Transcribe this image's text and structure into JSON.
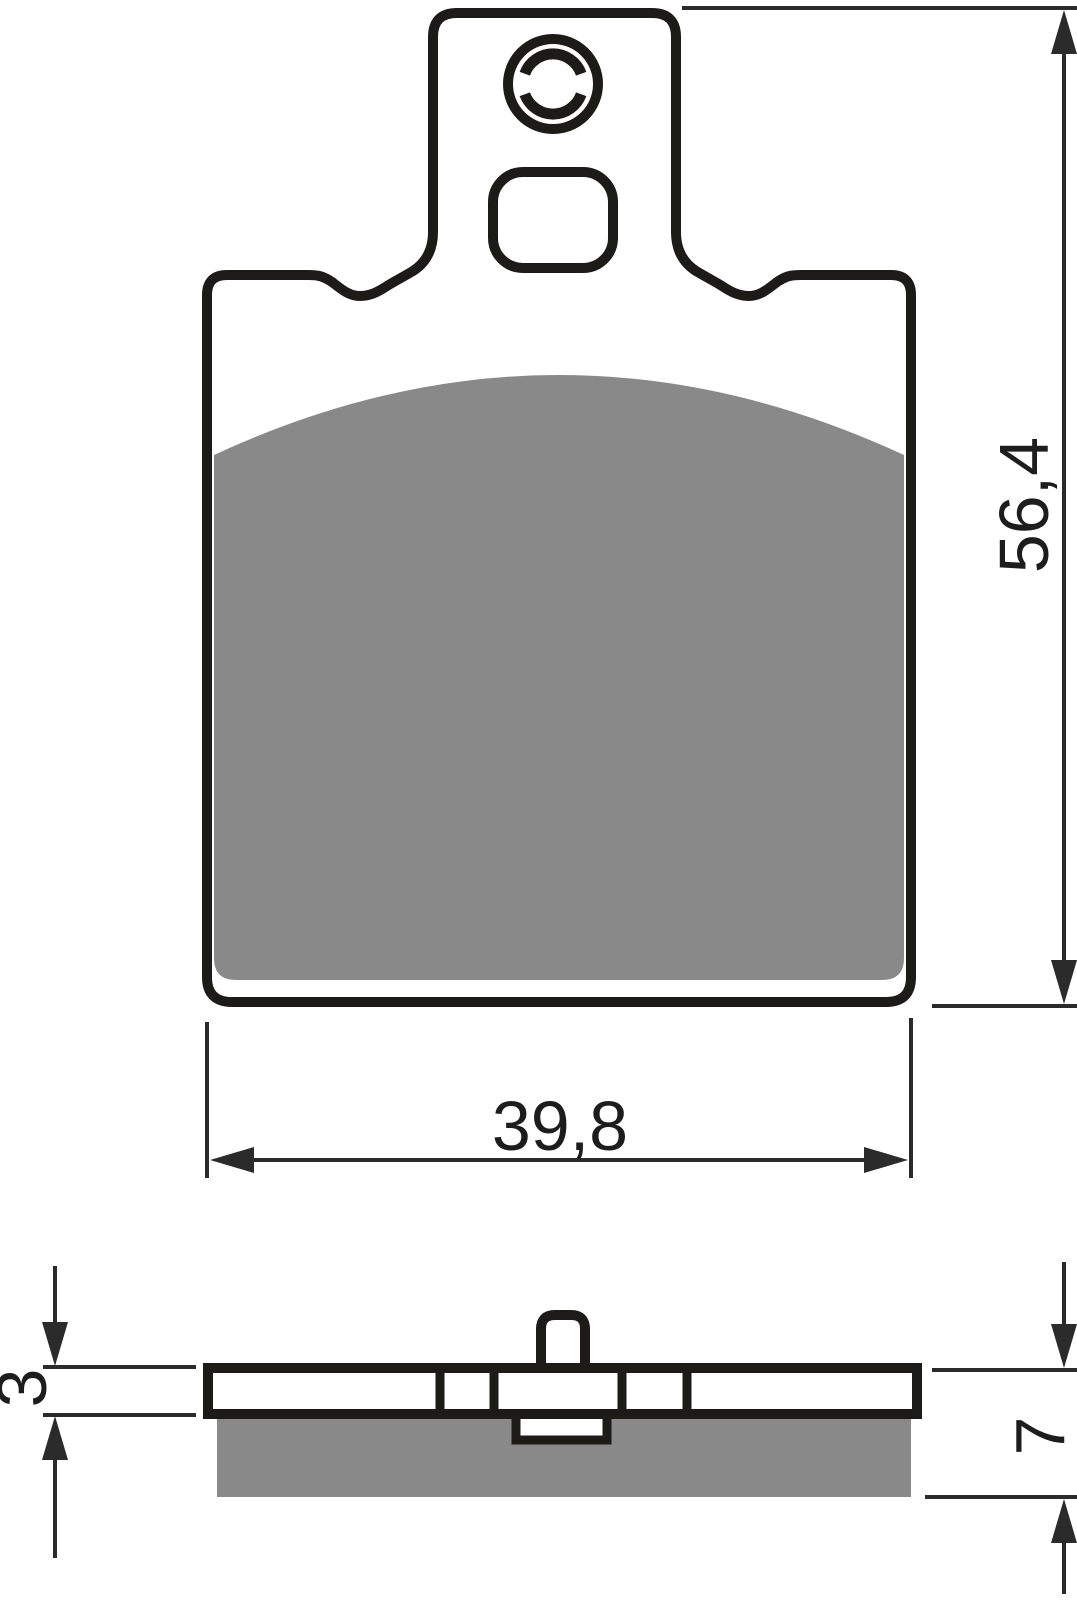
{
  "dimensions": {
    "overall_height": {
      "label": "56,4"
    },
    "overall_width": {
      "label": "39,8"
    },
    "backplate_thickness": {
      "label": "3"
    },
    "total_thickness": {
      "label": "7"
    }
  },
  "colors": {
    "line": "#1d1b18",
    "dim_line": "#2b2b2b",
    "friction_material": "#898989",
    "background": "#ffffff"
  }
}
